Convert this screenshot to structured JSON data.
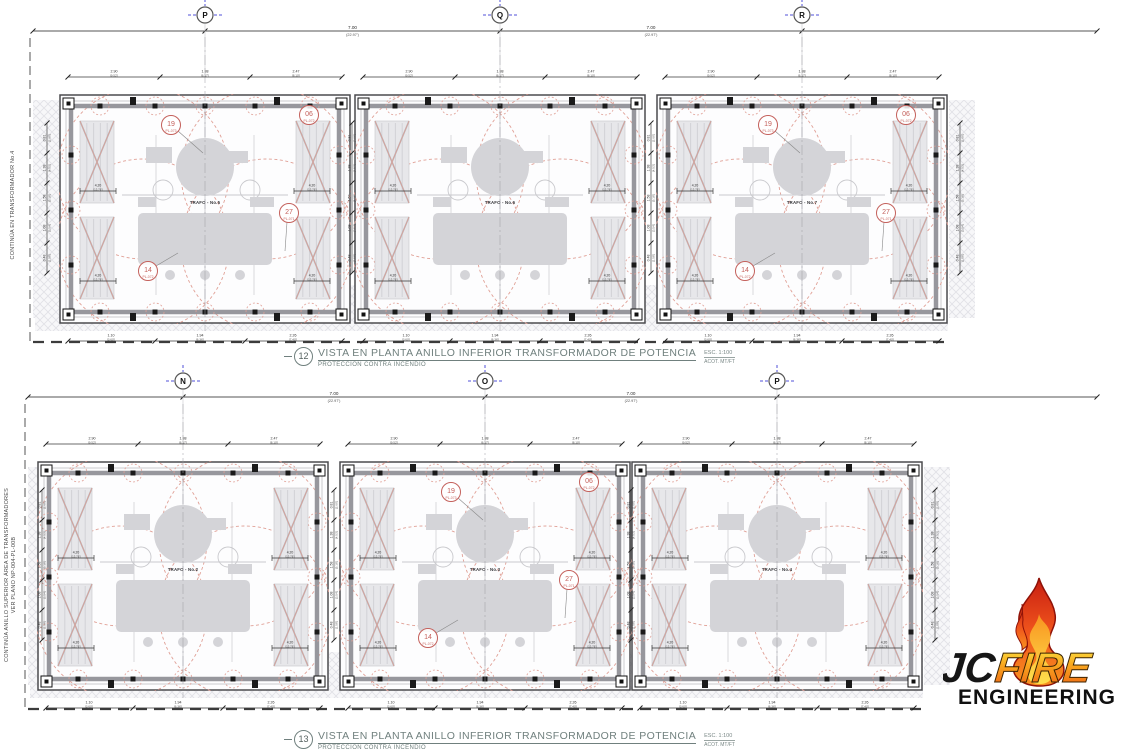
{
  "drawings": [
    {
      "number": "12",
      "title": "VISTA EN PLANTA ANILLO INFERIOR TRANSFORMADOR DE POTENCIA",
      "subtitle": "PROTECCIÓN CONTRA INCENDIO",
      "scale": "ESC. 1:100",
      "units": "ACOT. MT/FT",
      "grid_labels": [
        "P",
        "Q",
        "R"
      ],
      "side_note_line1": "CONTINÚA EN TRANSFORMADOR No.4",
      "side_note_line2": "",
      "trafo_labels": [
        "TRAFO - No.5",
        "TRAFO - No.6",
        "TRAFO - No.7"
      ]
    },
    {
      "number": "13",
      "title": "VISTA EN PLANTA ANILLO INFERIOR TRANSFORMADOR DE POTENCIA",
      "subtitle": "PROTECCIÓN CONTRA INCENDIO",
      "scale": "ESC. 1:100",
      "units": "ACOT. MT/FT",
      "grid_labels": [
        "N",
        "O",
        "P"
      ],
      "side_note_line1": "CONTINÚA ANILLO SUPERIOR ÁREA DE TRANSFORMADORES",
      "side_note_line2": "VER PLANO NP-004-PL-00B",
      "trafo_labels": [
        "TRAFO - No.2",
        "TRAFO - No.3",
        "TRAFO - No.4"
      ]
    }
  ],
  "callouts": [
    {
      "num": "19",
      "tag": "PL-073"
    },
    {
      "num": "06",
      "tag": "PL-072"
    },
    {
      "num": "27",
      "tag": "PL-071"
    },
    {
      "num": "14",
      "tag": "PL-072"
    }
  ],
  "dims": {
    "main": {
      "m": "7.00",
      "ft": "(22.97')"
    },
    "top": [
      {
        "m": "2.90",
        "ft": "[9.52']"
      },
      {
        "m": "1.88",
        "ft": "[6.17']"
      },
      {
        "m": "2.47",
        "ft": "[8.10']"
      }
    ],
    "bottom": [
      {
        "m": "1.10",
        "ft": "[3.60']"
      },
      {
        "m": "1.94",
        "ft": "[6.36']"
      },
      {
        "m": "2.26",
        "ft": "[7.40']"
      }
    ],
    "side": [
      {
        "m": "0.81",
        "ft": "[2.66']"
      },
      {
        "m": "1.38",
        "ft": "[4.53']"
      },
      {
        "m": "1.58",
        "ft": "[5.18']"
      },
      {
        "m": "1.08",
        "ft": "[3.54']"
      },
      {
        "m": "0.48",
        "ft": "[1.58']"
      }
    ],
    "stub": {
      "m": "4.20",
      "ft": "[13.78']"
    }
  },
  "colors": {
    "red_dash": "#e0a096",
    "callout_red": "#c4615c",
    "grid_blue": "#5050d8",
    "equipment_gray": "#d4d4d8",
    "line_dark": "#4b4b4f"
  },
  "logo": {
    "jc": "JC",
    "fire": "FIRE",
    "engineering": "ENGINEERING"
  }
}
